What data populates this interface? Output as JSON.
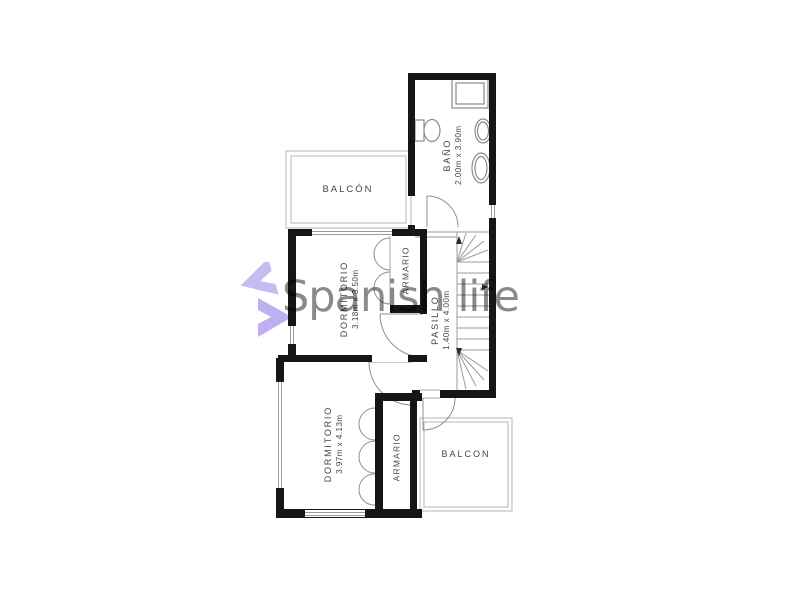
{
  "watermark": {
    "text": "Spanish life",
    "text_color": "#8a8a8a",
    "logo": {
      "name": "spanish-life-logo",
      "top_color": "#c7bbf3",
      "bottom_color": "#beaff0"
    }
  },
  "plan": {
    "wall_color": "#161616",
    "thin_line_color": "#aaaaaa",
    "label_color": "#454545",
    "rooms": {
      "bano": {
        "label": "BAÑO",
        "dims": "2.00m x 3.90m"
      },
      "balcon_top": {
        "label": "BALCÓN"
      },
      "dormitorio1": {
        "label": "DORMITORIO",
        "dims": "3.18m x 3.50m"
      },
      "armario1": {
        "label": "ARMARIO"
      },
      "pasillo": {
        "label": "PASILLO",
        "dims": "1.40m x 4.00m"
      },
      "dormitorio2": {
        "label": "DORMITORIO",
        "dims": "3.97m x 4.13m"
      },
      "armario2": {
        "label": "ARMARIO"
      },
      "balcon_bottom": {
        "label": "BALCON"
      }
    }
  }
}
